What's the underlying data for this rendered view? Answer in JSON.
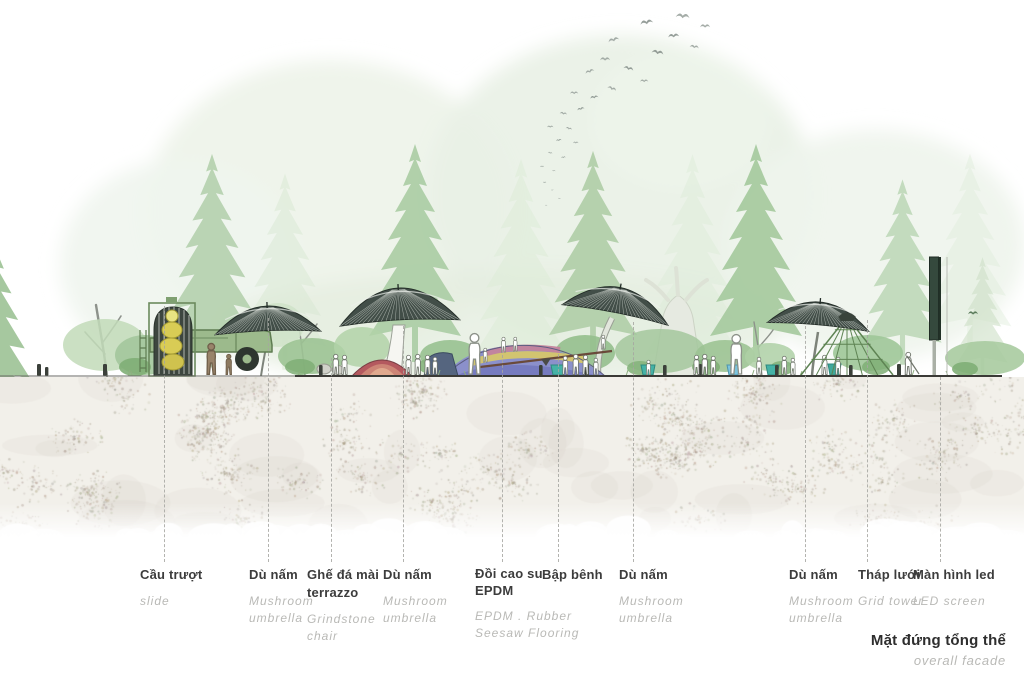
{
  "title": {
    "vi": "Mặt đứng tổng thể",
    "en": "overall facade"
  },
  "annotations": [
    {
      "id": "slide",
      "vi": "Cầu trượt",
      "en": "slide"
    },
    {
      "id": "mushroom-umbrella-1",
      "vi": "Dù nấm",
      "en": "Mushroom umbrella"
    },
    {
      "id": "grindstone-chair",
      "vi": "Ghế đá mài terrazzo",
      "en": "Grindstone chair"
    },
    {
      "id": "mushroom-umbrella-2",
      "vi": "Dù nấm",
      "en": "Mushroom umbrella"
    },
    {
      "id": "epdm-hill",
      "vi": "Đồi cao su EPDM",
      "en": "EPDM . Rubber Seesaw Flooring"
    },
    {
      "id": "seesaw",
      "vi": "Bập bênh",
      "en": ""
    },
    {
      "id": "mushroom-umbrella-3",
      "vi": "Dù nấm",
      "en": "Mushroom umbrella"
    },
    {
      "id": "mushroom-umbrella-4",
      "vi": "Dù nấm",
      "en": "Mushroom umbrella"
    },
    {
      "id": "grid-tower",
      "vi": "Tháp lưới",
      "en": "Grid tower"
    },
    {
      "id": "led-screen",
      "vi": "Màn hình led",
      "en": "LED screen"
    }
  ],
  "palette": {
    "tree_light": "#cfe2ca",
    "tree_mid": "#a9cba0",
    "umbrella_canopy_dark": "#424e48",
    "ground_speckle": "#a89e8e",
    "slide_yellow": "#d9cc55",
    "truck_green": "#9cba8c",
    "hill_purple": "#8b90cb",
    "hill_yellow": "#d6c76a",
    "hill_pink": "#c4849c",
    "planter_teal": "#45b2a6",
    "led_screen_green": "#35493d",
    "label_dark": "#3c3c3c",
    "label_gray": "#b9b9b6"
  }
}
